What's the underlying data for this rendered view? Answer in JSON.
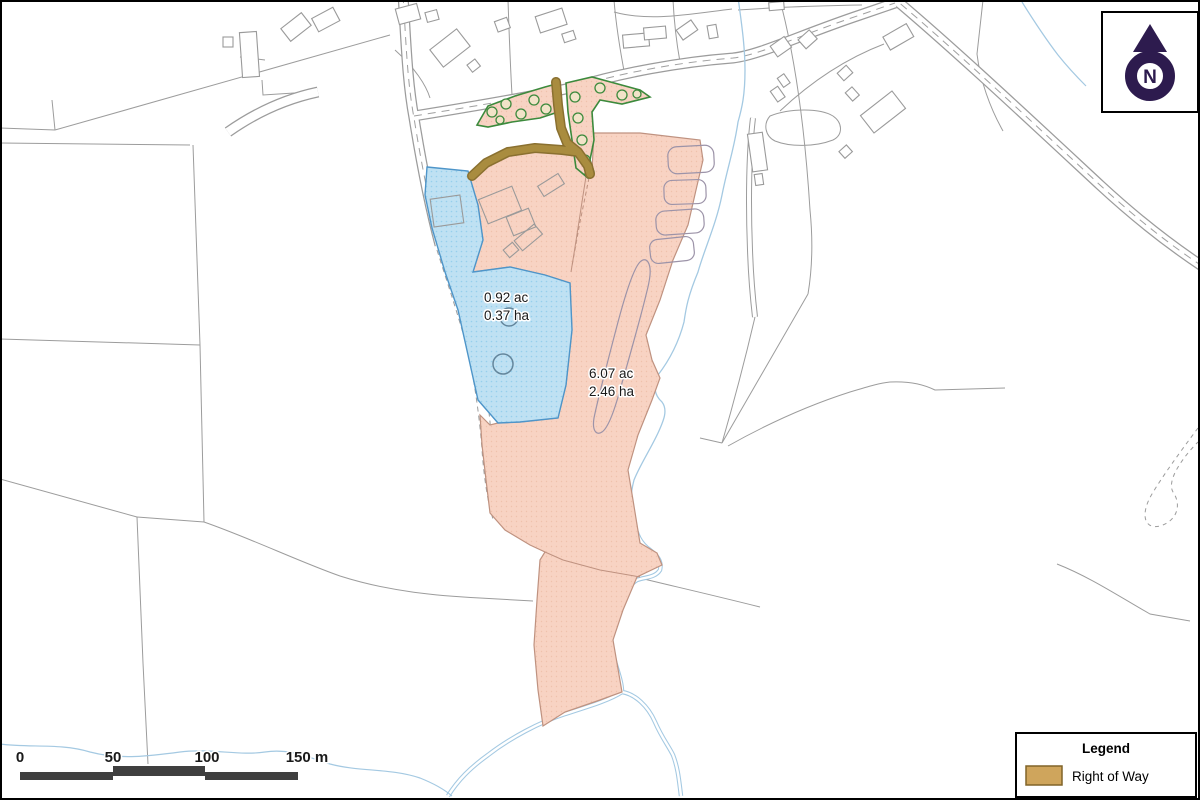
{
  "map": {
    "north_arrow": {
      "label": "N",
      "color": "#2d1b4e"
    },
    "parcels": [
      {
        "name": "blue-parcel",
        "area_acres": "0.92 ac",
        "area_hectares": "0.37 ha",
        "fill": "#bfe1f3",
        "outline": "#4e95c9"
      },
      {
        "name": "pink-parcel",
        "area_acres": "6.07 ac",
        "area_hectares": "2.46 ha",
        "fill": "#f8d3c3",
        "outline": "#bf9280"
      }
    ],
    "right_of_way": {
      "color": "#a98c3f"
    },
    "scale_bar": {
      "labels": [
        "0",
        "50",
        "100",
        "150 m"
      ],
      "bar_color": "#3f3f3f"
    },
    "legend": {
      "title": "Legend",
      "items": [
        {
          "label": "Right of Way",
          "swatch_fill": "#cfa55c"
        }
      ]
    }
  }
}
